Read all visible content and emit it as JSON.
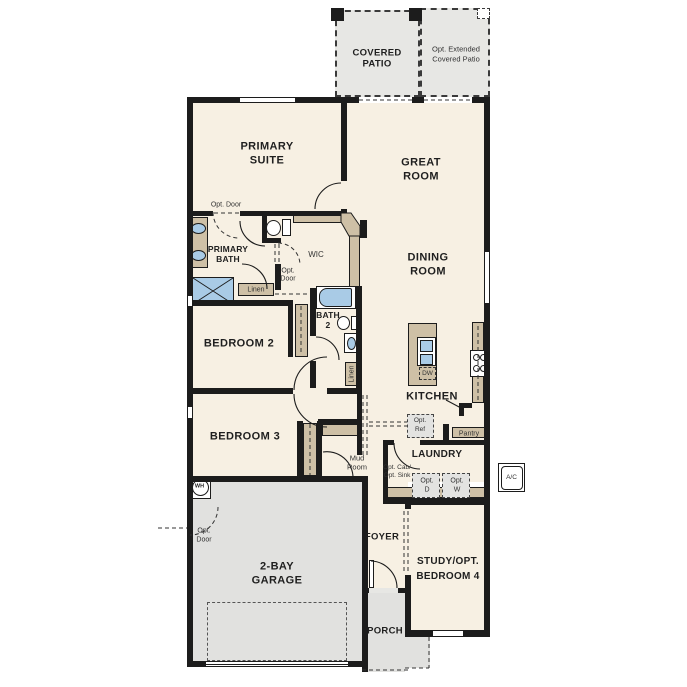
{
  "rooms": {
    "covered_patio": {
      "l1": "COVERED",
      "l2": "PATIO"
    },
    "opt_extended_patio": {
      "l1": "Opt. Extended",
      "l2": "Covered Patio"
    },
    "primary_suite": {
      "l1": "PRIMARY",
      "l2": "SUITE"
    },
    "great_room": {
      "l1": "GREAT",
      "l2": "ROOM"
    },
    "dining_room": {
      "l1": "DINING",
      "l2": "ROOM"
    },
    "primary_bath": {
      "l1": "PRIMARY",
      "l2": "BATH"
    },
    "wic": {
      "l1": "WIC"
    },
    "bath_2": {
      "l1": "BATH",
      "l2": "2"
    },
    "bedroom_2": {
      "l1": "BEDROOM 2"
    },
    "bedroom_3": {
      "l1": "BEDROOM 3"
    },
    "kitchen": {
      "l1": "KITCHEN"
    },
    "laundry": {
      "l1": "LAUNDRY"
    },
    "mud_room": {
      "l1": "Mud",
      "l2": "Room"
    },
    "foyer": {
      "l1": "FOYER"
    },
    "garage": {
      "l1": "2-BAY",
      "l2": "GARAGE"
    },
    "study": {
      "l1": "STUDY/OPT.",
      "l2": "BEDROOM 4"
    },
    "porch": {
      "l1": "PORCH"
    }
  },
  "annotations": {
    "opt_door_suite": {
      "l1": "Opt. Door"
    },
    "opt_door_wic": {
      "l1": "Opt.",
      "l2": "Door"
    },
    "opt_door_garage": {
      "l1": "Opt.",
      "l2": "Door"
    },
    "linen_bath": {
      "l1": "Linen"
    },
    "linen_hall": {
      "l1": "Linen"
    },
    "pantry": {
      "l1": "Pantry"
    },
    "dishwasher": {
      "l1": "DW"
    },
    "opt_ref": {
      "l1": "Opt.",
      "l2": "Ref"
    },
    "opt_cab_sink": {
      "l1": "Opt. Cab/",
      "l2": "Opt. Sink"
    },
    "opt_dryer": {
      "l1": "Opt.",
      "l2": "D"
    },
    "opt_washer": {
      "l1": "Opt.",
      "l2": "W"
    },
    "water_heater": {
      "l1": "WH"
    },
    "ac_unit": {
      "l1": "A/C"
    }
  },
  "colors": {
    "wall": "#1c1c1c",
    "interior": "#f7f0e3",
    "patio": "#e7e7e4",
    "garage": "#e1e1df",
    "cabinet": "#cec0a6",
    "fixture_blue": "#a9cbe6"
  }
}
